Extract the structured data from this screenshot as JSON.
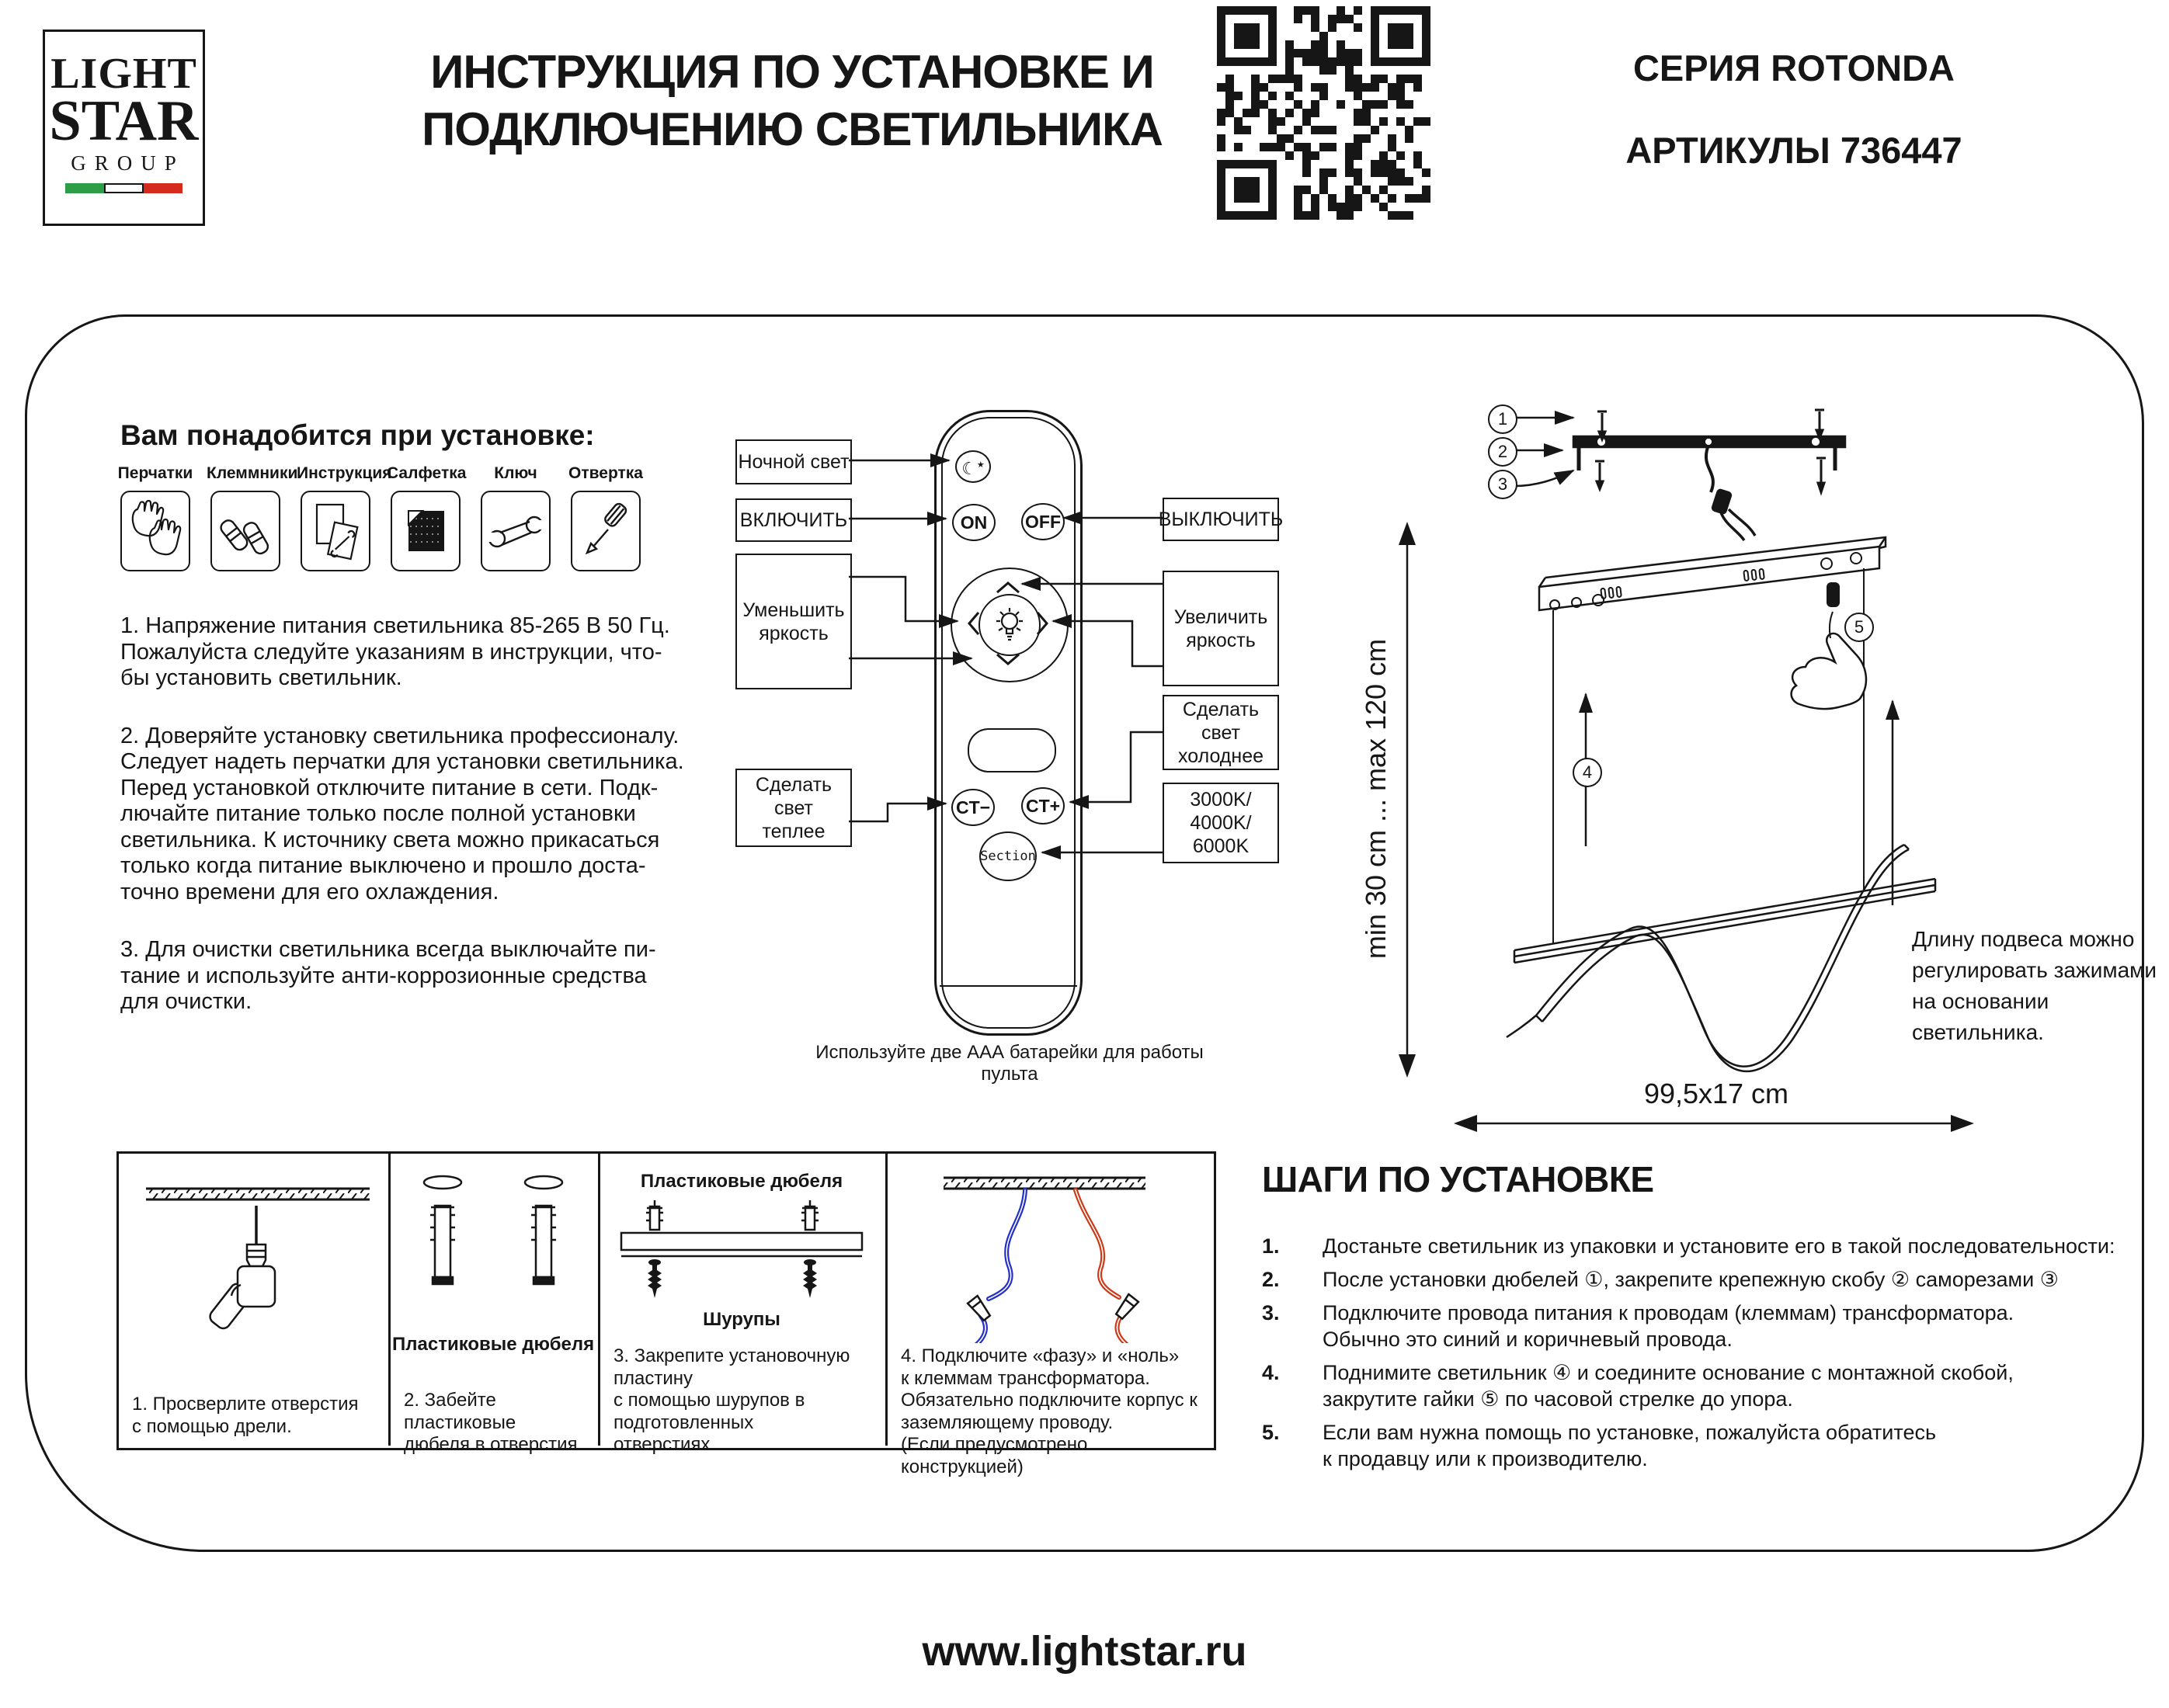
{
  "header": {
    "logo": {
      "line1": "LIGHT",
      "line2": "STAR",
      "line3": "GROUP",
      "flag_colors": [
        "#2e9e46",
        "#ffffff",
        "#d42b1e"
      ]
    },
    "title": "ИНСТРУКЦИЯ ПО УСТАНОВКЕ И\nПОДКЛЮЧЕНИЮ СВЕТИЛЬНИКА",
    "series": "СЕРИЯ ROTONDA",
    "articles": "АРТИКУЛЫ 736447"
  },
  "tools": {
    "heading": "Вам понадобится при установке:",
    "items": [
      {
        "label": "Перчатки",
        "icon": "gloves-icon"
      },
      {
        "label": "Клеммники",
        "icon": "terminals-icon"
      },
      {
        "label": "Инструкция",
        "icon": "manual-icon"
      },
      {
        "label": "Салфетка",
        "icon": "napkin-icon"
      },
      {
        "label": "Ключ",
        "icon": "wrench-icon"
      },
      {
        "label": "Отвертка",
        "icon": "screwdriver-icon"
      }
    ]
  },
  "notes": {
    "p1": "1. Напряжение питания светильника 85-265 В 50 Гц.\nПожалуйста следуйте указаниям в инструкции, что-\nбы установить светильник.",
    "p2": "2. Доверяйте установку светильника профессионалу.\nСледует надеть перчатки для установки светильника.\nПеред установкой отключите питание в сети. Подк-\nлючайте питание только после полной установки\nсветильника. К источнику света можно прикасаться\nтолько когда питание выключено и прошло доста-\nточно времени для его охлаждения.",
    "p3": "3. Для очистки светильника всегда выключайте пи-\nтание и используйте анти-коррозионные средства\nдля очистки."
  },
  "remote": {
    "buttons": {
      "on": "ON",
      "off": "OFF",
      "ct_minus": "CT−",
      "ct_plus": "CT+",
      "section": "Section"
    },
    "callouts": {
      "night": "Ночной свет",
      "power_on": "ВКЛЮЧИТЬ",
      "power_off": "ВЫКЛЮЧИТЬ",
      "dim": "Уменьшить\nяркость",
      "bright": "Увеличить\nяркость",
      "warm": "Сделать\nсвет\nтеплее",
      "cold": "Сделать\nсвет\nхолоднее",
      "kelvin": "3000K/\n4000K/\n6000K"
    },
    "battery_note": "Используйте две ААА батарейки для работы пульта"
  },
  "diagram": {
    "markers": [
      "1",
      "2",
      "3",
      "4",
      "5"
    ],
    "adjust_note": "Длину подвеса можно\nрегулировать зажимами\nна основании светильника.",
    "height_range": "min 30 cm ... max 120 cm",
    "size_label": "99,5x17 cm"
  },
  "steps": {
    "heading": "ШАГИ ПО УСТАНОВКЕ",
    "items": [
      {
        "num": "1.",
        "text": "Достаньте светильник из упаковки и установите его в такой последовательности:"
      },
      {
        "num": "2.",
        "text": "После установки дюбелей ①, закрепите крепежную скобу ②  саморезами  ③"
      },
      {
        "num": "3.",
        "text": "Подключите провода питания к проводам (клеммам) трансформатора.\nОбычно это синий и коричневый провода."
      },
      {
        "num": "4.",
        "text": "Поднимите светильник ④ и соедините основание с монтажной скобой,\nзакрутите гайки ⑤ по часовой стрелке до упора."
      },
      {
        "num": "5.",
        "text": "Если вам нужна помощь по установке, пожалуйста обратитесь\n к продавцу или к производителю."
      }
    ]
  },
  "panels": [
    {
      "caption": "1. Просверлите отверстия\nс помощью дрели."
    },
    {
      "label": "Пластиковые дюбеля",
      "caption": "2. Забейте пластиковые\nдюбеля в отверстия."
    },
    {
      "label_top": "Пластиковые дюбеля",
      "label_bottom": "Шурупы",
      "caption": "3. Закрепите установочную пластину\nс помощью шурупов в подготовленных\nотверстиях."
    },
    {
      "caption": "4. Подключите «фазу» и «ноль»\nк клеммам трансформатора.\nОбязательно подключите корпус к\nзаземляющему проводу.\n(Если предусмотрено конструкцией)"
    }
  ],
  "footer": {
    "url": "www.lightstar.ru"
  },
  "colors": {
    "ink": "#161616",
    "wire_blue": "#2430c8",
    "wire_red": "#cd3a17"
  }
}
